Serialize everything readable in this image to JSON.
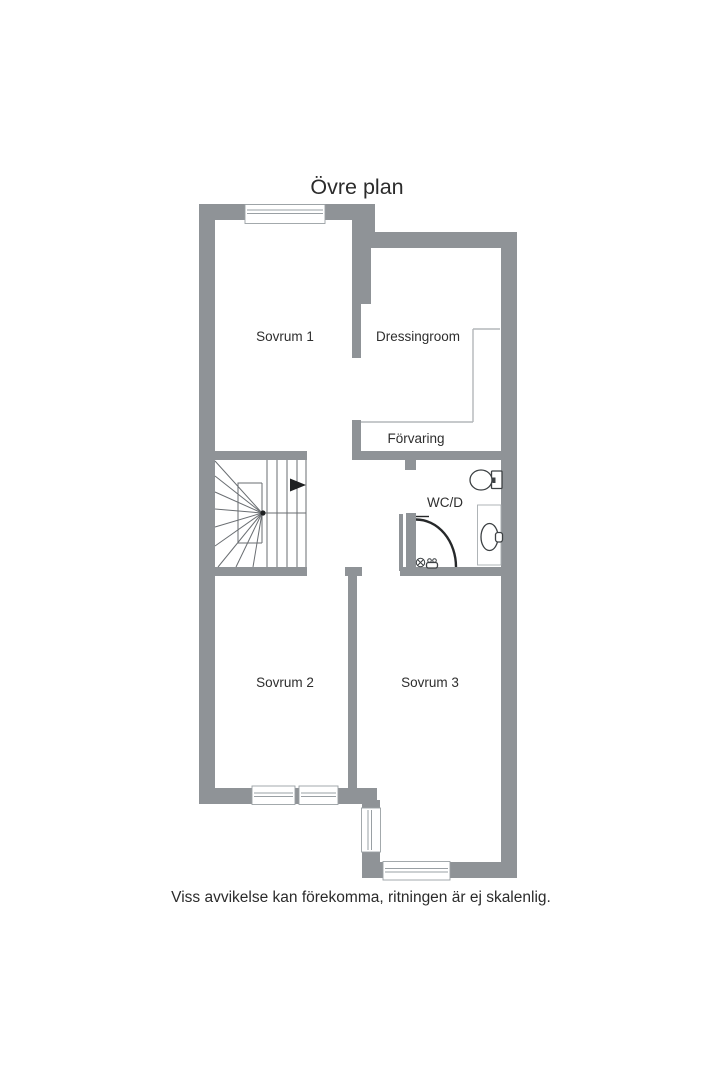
{
  "page": {
    "title": "Övre plan",
    "disclaimer": "Viss avvikelse kan förekomma, ritningen är ej skalenlig."
  },
  "rooms": {
    "sovrum1": "Sovrum 1",
    "dressingroom": "Dressingroom",
    "forvaring": "Förvaring",
    "wcd": "WC/D",
    "sovrum2": "Sovrum 2",
    "sovrum3": "Sovrum 3"
  },
  "fixtures": {
    "toilet": "toilet-icon",
    "washbasin": "washbasin-icon",
    "shower": "shower-enclosure-icon",
    "stairs": "staircase-icon",
    "direction_arrow": "stair-direction-arrow-icon"
  },
  "colors": {
    "wall": "#8f9397",
    "window_frame": "#9aa0a4",
    "closet_line": "#b3b7ba",
    "stair_line": "#6a6e72",
    "fixture_stroke": "#3c4043",
    "text": "#2b2b2b",
    "background": "#ffffff"
  }
}
